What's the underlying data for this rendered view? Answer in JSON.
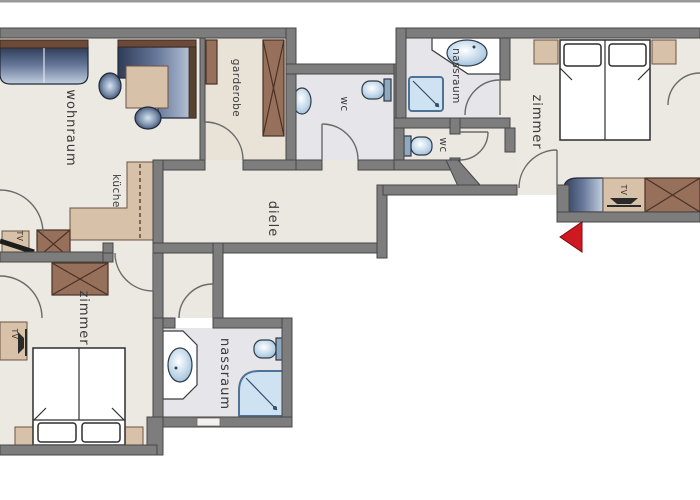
{
  "title": "apartment floor plan",
  "rooms": {
    "wohnraum": {
      "label": "wohnraum"
    },
    "kueche": {
      "label": "küche"
    },
    "garderobe": {
      "label": "garderobe"
    },
    "wc_main": {
      "label": "wc"
    },
    "nassraum_top": {
      "label": "nassraum"
    },
    "zimmer_right": {
      "label": "zimmer"
    },
    "wc_small": {
      "label": "wc"
    },
    "diele": {
      "label": "diele"
    },
    "zimmer_left": {
      "label": "zimmer"
    },
    "nassraum_bottom": {
      "label": "nassraum"
    }
  },
  "furniture_labels": {
    "tv_livingroom": "TV",
    "tv_zimmer_right": "TV",
    "tv_zimmer_left": "TV"
  },
  "markers": {
    "entrance_arrow": "entrance-direction"
  },
  "colors": {
    "wall": "#7d7d7d",
    "wall_outline": "#474747",
    "floor_living": "#ece8e2",
    "floor_bath": "#e6e6ea",
    "floor_garderobe": "#e9e2d7",
    "kitchen_tan": "#d8c1a9",
    "wardrobe_brown": "#96705a",
    "sofa_navy": "#31405e",
    "shower_blue": "#cfe2f2",
    "entrance_red": "#d01820"
  }
}
